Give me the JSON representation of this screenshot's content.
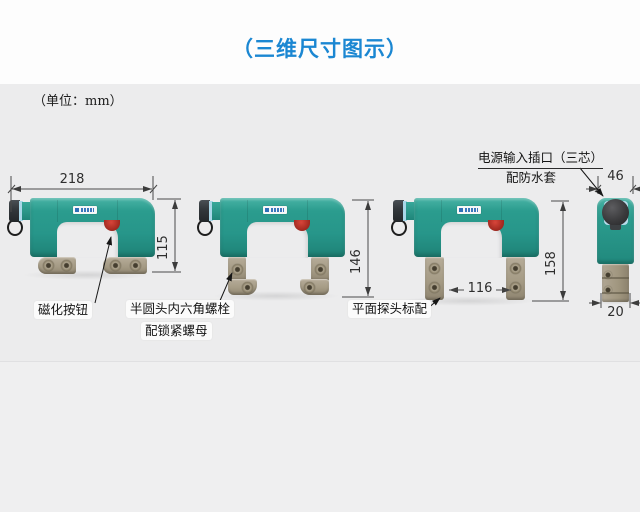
{
  "header": {
    "title": "（三维尺寸图示）",
    "unit_note": "（单位：mm）"
  },
  "dimensions": {
    "overall_width": "218",
    "body_height": "115",
    "articulated_height": "146",
    "pole_spacing": "116",
    "extended_height": "158",
    "side_width": "46",
    "side_foot_width": "20"
  },
  "callouts": {
    "magnetize_button": "磁化按钮",
    "hex_bolt_line1": "半圆头内六角螺栓",
    "hex_bolt_line2": "配锁紧螺母",
    "flat_probe": "平面探头标配",
    "power_socket_line1": "电源输入插口（三芯）",
    "power_socket_line2": "配防水套"
  },
  "colors": {
    "accent_blue": "#1b87d2",
    "device_teal": "#27968a",
    "button_red": "#b03228",
    "foot_tan": "#a89e8c",
    "background_gray": "#ececed"
  }
}
